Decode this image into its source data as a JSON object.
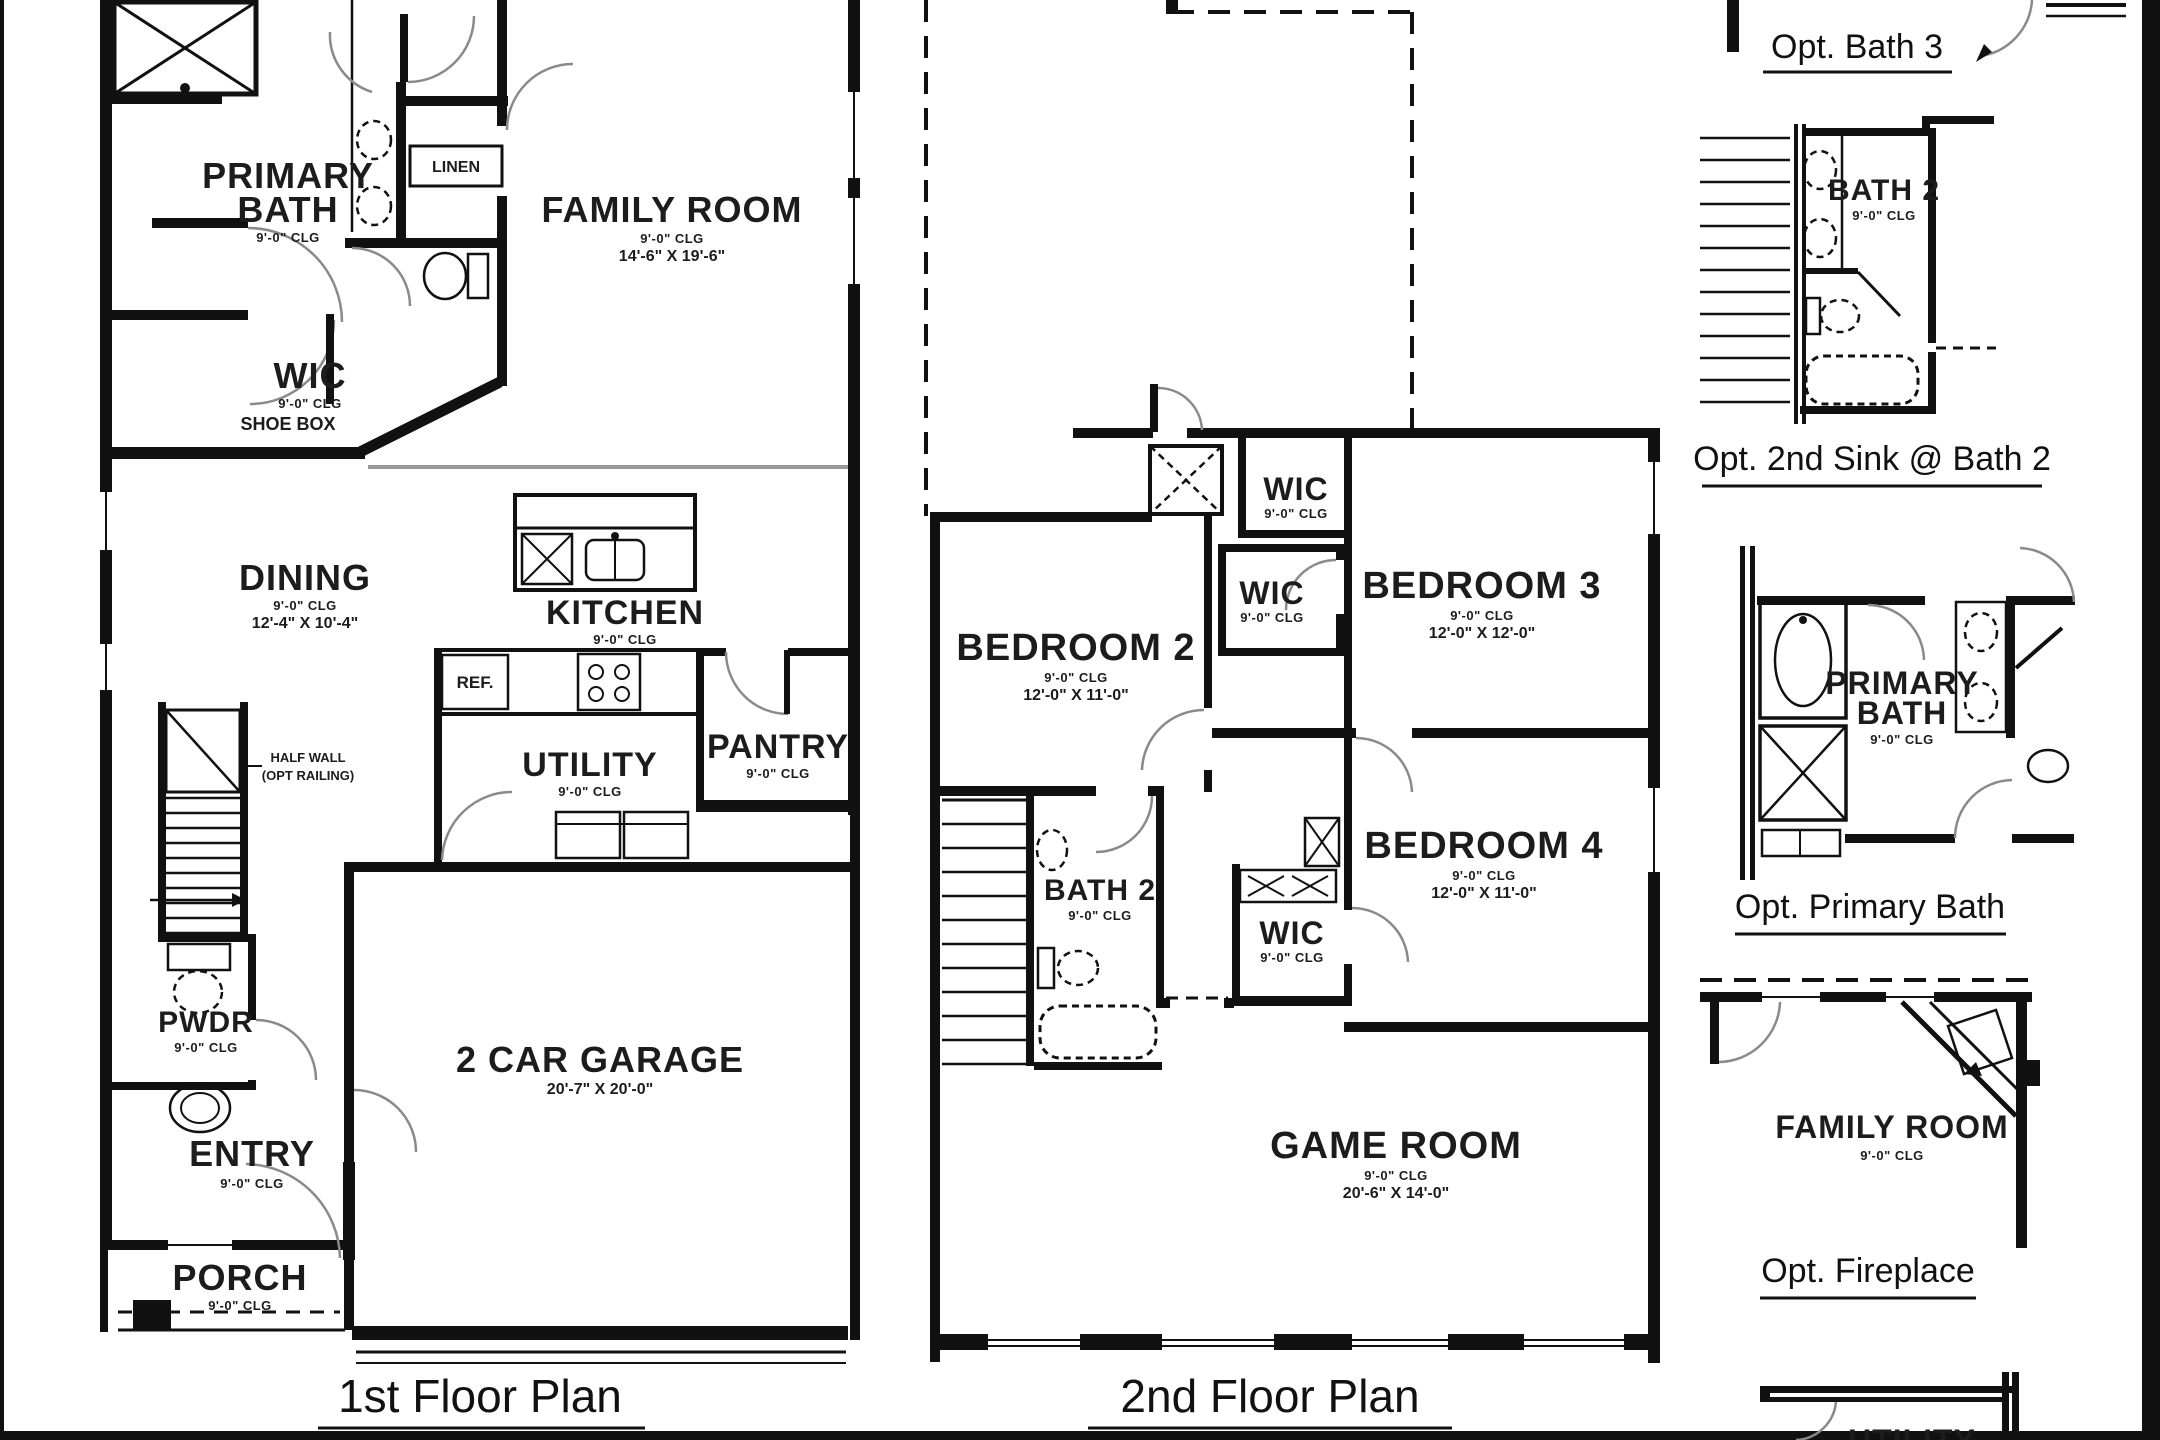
{
  "document": {
    "background": "#ffffff",
    "ink": "#111111",
    "arc_gray": "#8a8a8a",
    "transition_gray": "#999999"
  },
  "floor1": {
    "title": "1st Floor Plan",
    "primary_bath": {
      "line1": "PRIMARY",
      "line2": "BATH",
      "clg": "9'-0\" CLG"
    },
    "linen": "LINEN",
    "wic": {
      "name": "WIC",
      "clg": "9'-0\" CLG",
      "note": "SHOE BOX"
    },
    "dining": {
      "name": "DINING",
      "clg": "9'-0\" CLG",
      "dims": "12'-4\" X 10'-4\""
    },
    "kitchen": {
      "name": "KITCHEN",
      "clg": "9'-0\" CLG"
    },
    "ref": "REF.",
    "utility": {
      "name": "UTILITY",
      "clg": "9'-0\" CLG"
    },
    "pantry": {
      "name": "PANTRY",
      "clg": "9'-0\" CLG"
    },
    "family_room": {
      "name": "FAMILY ROOM",
      "clg": "9'-0\" CLG",
      "dims": "14'-6\" X 19'-6\""
    },
    "half_wall": {
      "line1": "HALF WALL",
      "line2": "(OPT RAILING)"
    },
    "pwdr": {
      "name": "PWDR",
      "clg": "9'-0\" CLG"
    },
    "entry": {
      "name": "ENTRY",
      "clg": "9'-0\" CLG"
    },
    "porch": {
      "name": "PORCH",
      "clg": "9'-0\" CLG"
    },
    "garage": {
      "name": "2 CAR GARAGE",
      "dims": "20'-7\" X 20'-0\""
    }
  },
  "floor2": {
    "title": "2nd Floor Plan",
    "bedroom2": {
      "name": "BEDROOM 2",
      "clg": "9'-0\" CLG",
      "dims": "12'-0\" X 11'-0\""
    },
    "bedroom3": {
      "name": "BEDROOM 3",
      "clg": "9'-0\" CLG",
      "dims": "12'-0\" X 12'-0\""
    },
    "bedroom4": {
      "name": "BEDROOM 4",
      "clg": "9'-0\" CLG",
      "dims": "12'-0\" X 11'-0\""
    },
    "wic_top": {
      "name": "WIC",
      "clg": "9'-0\" CLG"
    },
    "wic_mid": {
      "name": "WIC",
      "clg": "9'-0\" CLG"
    },
    "wic_low": {
      "name": "WIC",
      "clg": "9'-0\" CLG"
    },
    "bath2": {
      "name": "BATH 2",
      "clg": "9'-0\" CLG"
    },
    "game_room": {
      "name": "GAME ROOM",
      "clg": "9'-0\" CLG",
      "dims": "20'-6\" X 14'-0\""
    }
  },
  "options": {
    "bath3_label": "Opt. Bath 3",
    "sink_label": "Opt. 2nd Sink @ Bath 2",
    "bath2_detail": {
      "name": "BATH 2",
      "clg": "9'-0\" CLG"
    },
    "primary_label": "Opt. Primary Bath",
    "primary_detail": {
      "line1": "PRIMARY",
      "line2": "BATH",
      "clg": "9'-0\" CLG"
    },
    "fireplace_label": "Opt. Fireplace",
    "family_detail": {
      "name": "FAMILY ROOM",
      "clg": "9'-0\" CLG"
    },
    "utility_detail": {
      "name": "UTILITY"
    }
  }
}
